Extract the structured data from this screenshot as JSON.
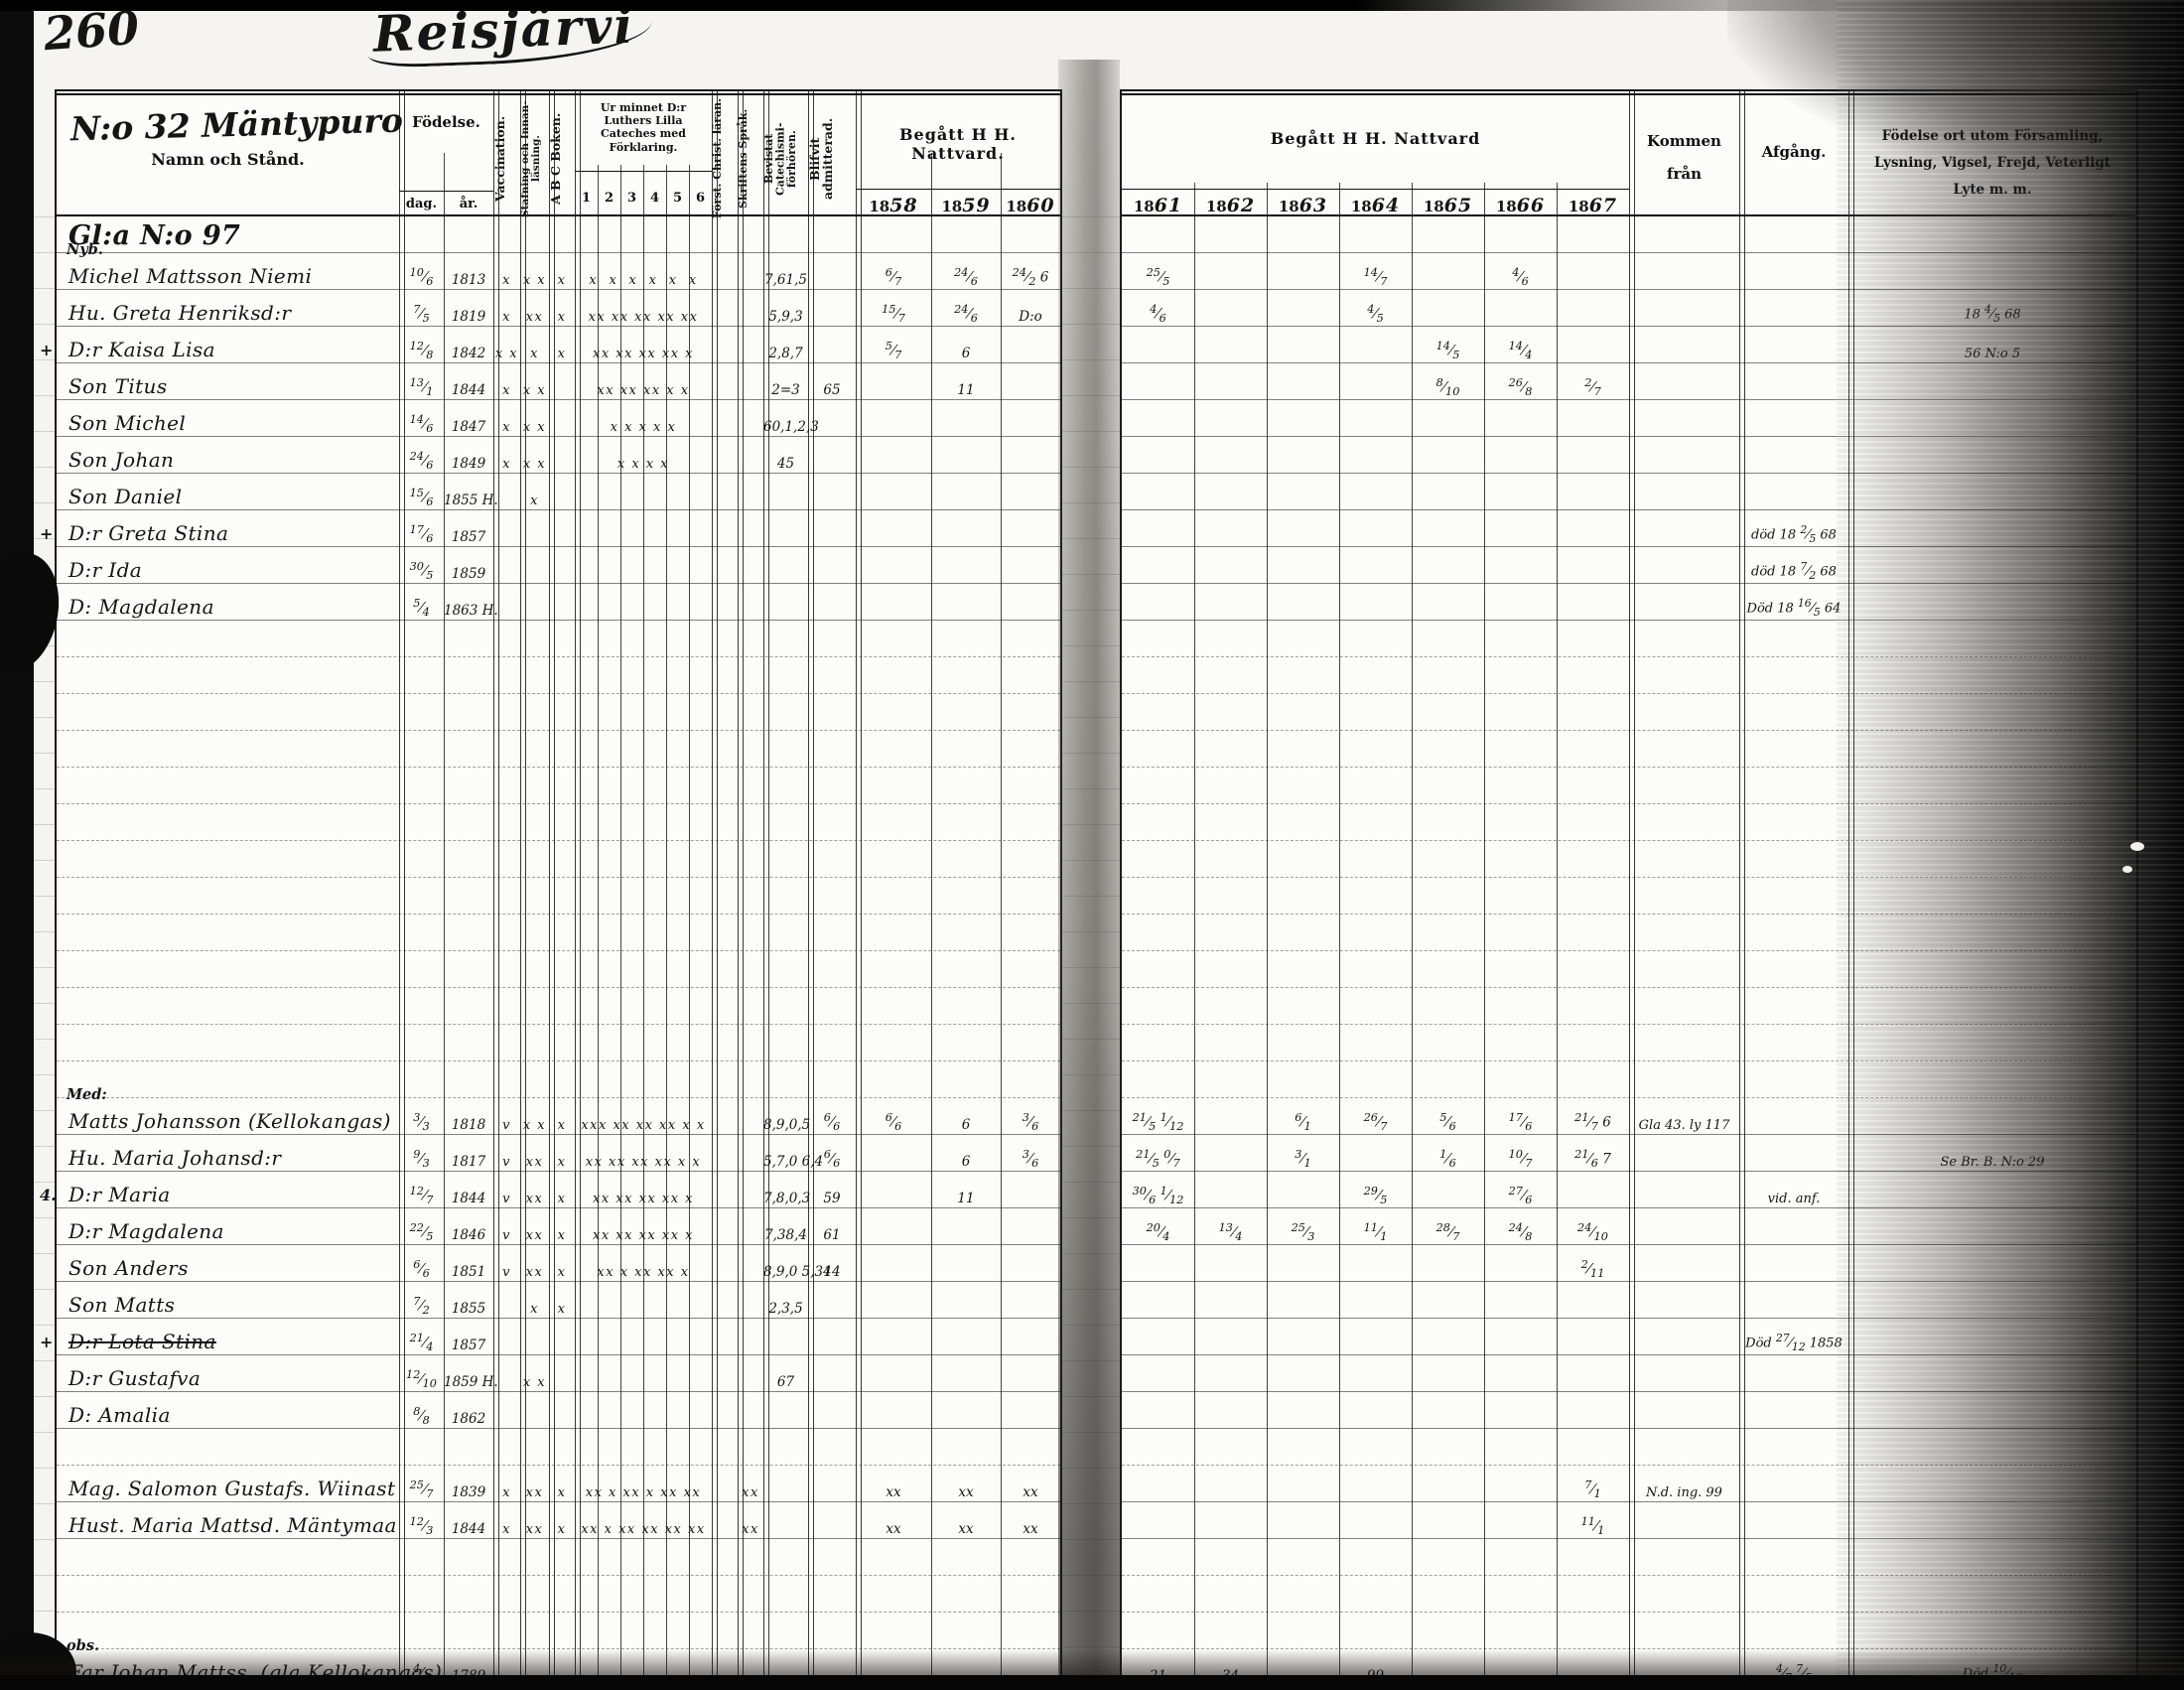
{
  "page": {
    "number": "260",
    "title": "Reisjärvi"
  },
  "left_header": {
    "household_no": "N:o 32 Mäntypuro",
    "name_label": "Namn och Stånd.",
    "birth": "Födelse.",
    "day": "dag.",
    "year": "år.",
    "vaccination": "Vaccination.",
    "reading": "Stafning och Innan-läsning.",
    "abc": "A B C Boken.",
    "catechism_title": "Ur minnet D:r Luthers Lilla Cateches med Förklaring.",
    "catechism_cols": [
      "1",
      "2",
      "3",
      "4",
      "5",
      "6"
    ],
    "christ": "Först. Christ. läran.",
    "scripture": "Skriftens Språk.",
    "exams": "Bevistat Catechismi-förhören.",
    "admitted": "Blifvit admitterad.",
    "communion_title": "Begått H H. Nattvard.",
    "years": [
      "1858",
      "1859",
      "1860"
    ]
  },
  "right_header": {
    "communion_title": "Begått H H. Nattvard",
    "years": [
      "1861",
      "1862",
      "1863",
      "1864",
      "1865",
      "1866",
      "1867"
    ],
    "from": "Kommen från",
    "departure": "Afgång.",
    "notes": "Födelse ort utom Församling, Lysning, Vigsel, Frejd, Veterligt Lyte m. m."
  },
  "rows": [
    {
      "name": "Gl:a N:o 97",
      "big": true
    },
    {
      "fam": "Nyb.",
      "name": "Michel Mattsson Niemi",
      "day": "10/6",
      "yr": "1813",
      "vac": "x",
      "staf": "x x",
      "abc": "x",
      "cat": "x  x  x  x  x  x",
      "fh": "7,61,5",
      "y58": "6/7",
      "y59": "24/6",
      "y60": "24/2 6",
      "y61": "25/5",
      "y64": "14/7",
      "y66": "4/6"
    },
    {
      "name": "Hu. Greta Henriksd:r",
      "day": "7/5",
      "yr": "1819",
      "vac": "x",
      "staf": "xx",
      "abc": "x",
      "cat": "xx xx xx xx xx",
      "fh": "5,9,3",
      "y58": "15/7",
      "y59": "24/6",
      "y60": "D:o",
      "y61": "4/6",
      "y64": "4/5",
      "not": "18 4/5 68"
    },
    {
      "m": "+",
      "name": "D:r Kaisa Lisa",
      "day": "12/8",
      "yr": "1842",
      "vac": "x x",
      "staf": "x",
      "abc": "x",
      "cat": "xx xx xx xx x",
      "fh": "2,8,7",
      "y58": "5/7",
      "y59": "6",
      "y65": "14/5",
      "y66": "14/4",
      "not": "56 N:o 5"
    },
    {
      "name": "Son Titus",
      "day": "13/1",
      "yr": "1844",
      "vac": "x",
      "staf": "x x",
      "cat": "xx xx xx x x",
      "fh": "2=3",
      "ad": "65",
      "y59": "11",
      "y65": "8/10",
      "y66": "26/8",
      "y67": "2/7"
    },
    {
      "name": "Son Michel",
      "day": "14/6",
      "yr": "1847",
      "vac": "x",
      "staf": "x x",
      "cat": "x x x x x",
      "fh": "60,1,2,3"
    },
    {
      "name": "Son Johan",
      "day": "24/6",
      "yr": "1849",
      "vac": "x",
      "staf": "x x",
      "cat": "x x x x",
      "fh": "45"
    },
    {
      "name": "Son Daniel",
      "day": "15/6",
      "yr": "1855 H.",
      "staf": "x"
    },
    {
      "m": "+",
      "name": "D:r Greta Stina",
      "day": "17/6",
      "yr": "1857",
      "afg": "död 18 2/5 68"
    },
    {
      "m": "+",
      "name": "D:r Ida",
      "day": "30/5",
      "yr": "1859",
      "afg": "död 18 7/2 68"
    },
    {
      "m": "+",
      "name": "D: Magdalena",
      "day": "5/4",
      "yr": "1863 H.",
      "afg": "Död 18 16/5 64"
    },
    {},
    {},
    {},
    {},
    {},
    {},
    {},
    {},
    {},
    {},
    {},
    {},
    {},
    {
      "fam": "Med:",
      "name": "Matts Johansson (Kellokangas)",
      "day": "3/3",
      "yr": "1818",
      "vac": "v",
      "staf": "x x",
      "abc": "x",
      "cat": "xxx xx xx xx x x",
      "fh": "8,9,0,5",
      "ad": "6/6",
      "y58": "6/6",
      "y59": "6",
      "y60": "3/6",
      "y61": "21/5 1/12",
      "y63": "6/1",
      "y64": "26/7",
      "y65": "5/6",
      "y66": "17/6",
      "y67": "21/7 6",
      "kom": "Gla 43. ly 117"
    },
    {
      "name": "Hu. Maria Johansd:r",
      "day": "9/3",
      "yr": "1817",
      "vac": "v",
      "staf": "xx",
      "abc": "x",
      "cat": "xx xx xx xx x x",
      "fh": "5,7,0 6,4",
      "ad": "6/6",
      "y59": "6",
      "y60": "3/6",
      "y61": "21/5 0/7",
      "y63": "3/1",
      "y65": "1/6",
      "y66": "10/7",
      "y67": "21/6 7",
      "not": "Se Br. B. N:o 29"
    },
    {
      "m": "4.",
      "name": "D:r Maria",
      "day": "12/7",
      "yr": "1844",
      "vac": "v",
      "staf": "xx",
      "abc": "x",
      "cat": "xx xx xx xx x",
      "fh": "7,8,0,3",
      "ad": "59",
      "y59": "11",
      "y61": "30/6 1/12",
      "y64": "29/5",
      "y66": "27/6",
      "afg": "vid. anf."
    },
    {
      "name": "D:r Magdalena",
      "day": "22/5",
      "yr": "1846",
      "vac": "v",
      "staf": "xx",
      "abc": "x",
      "cat": "xx xx xx xx x",
      "fh": "7,38,4",
      "ad": "61",
      "y61": "20/4",
      "y62": "13/4",
      "y63": "25/3",
      "y64": "11/1",
      "y65": "28/7",
      "y66": "24/8",
      "y67": "24/10"
    },
    {
      "name": "Son Anders",
      "day": "6/6",
      "yr": "1851",
      "vac": "v",
      "staf": "xx",
      "abc": "x",
      "cat": "xx x xx xx x",
      "fh": "8,9,0 5,34",
      "ad": "14",
      "y67": "2/11"
    },
    {
      "name": "Son Matts",
      "day": "7/2",
      "yr": "1855",
      "staf": "x",
      "abc": "x",
      "fh": "2,3,5"
    },
    {
      "m": "+",
      "name": "D:r Lota Stina",
      "strike": true,
      "day": "21/4",
      "yr": "1857",
      "afg": "Död 27/12 1858"
    },
    {
      "name": "D:r Gustafva",
      "day": "12/10",
      "yr": "1859 H.",
      "staf": "x x",
      "fh": "67"
    },
    {
      "name": "D: Amalia",
      "day": "8/8",
      "yr": "1862"
    },
    {},
    {
      "name": "Mag. Salomon Gustafs. Wiinast",
      "day": "25/7",
      "yr": "1839",
      "vac": "x",
      "staf": "xx",
      "abc": "x",
      "cat": "xx x xx x xx xx",
      "sp": "xx",
      "y58": "xx",
      "y59": "xx",
      "y60": "xx",
      "y67": "7/1",
      "kom": "N.d. ing. 99"
    },
    {
      "name": "Hust. Maria Mattsd. Mäntymaa",
      "day": "12/3",
      "yr": "1844",
      "vac": "x",
      "staf": "xx",
      "abc": "x",
      "cat": "xx x xx xx xx xx",
      "sp": "xx",
      "y58": "xx",
      "y59": "xx",
      "y60": "xx",
      "y67": "11/1"
    },
    {},
    {},
    {},
    {
      "m": "+",
      "fam": "obs.",
      "name": "Far Johan Mattss. (gla Kellokangas)",
      "day": "4/4",
      "yr": "1789",
      "y61": "21",
      "y62": "34",
      "y64": "99",
      "afg": "4/7 7/5",
      "not": "Död 10/12"
    },
    {}
  ]
}
